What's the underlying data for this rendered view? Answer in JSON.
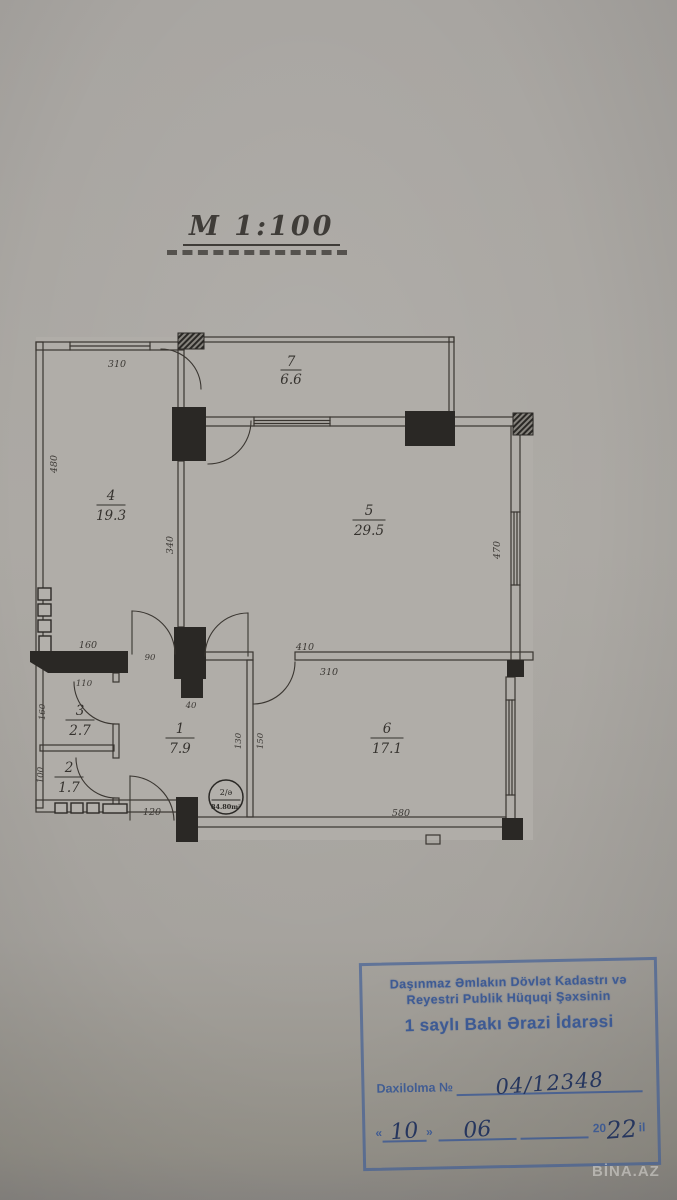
{
  "title": {
    "scale": "M 1:100"
  },
  "watermarks": {
    "center": "BİNA.AZ",
    "corner": "BİNA.AZ"
  },
  "plan": {
    "rooms": [
      {
        "number": "7",
        "area": "6.6"
      },
      {
        "number": "4",
        "area": "19.3"
      },
      {
        "number": "5",
        "area": "29.5"
      },
      {
        "number": "1",
        "area": "7.9"
      },
      {
        "number": "3",
        "area": "2.7"
      },
      {
        "number": "2",
        "area": "1.7"
      },
      {
        "number": "6",
        "area": "17.1"
      }
    ],
    "dims": {
      "room4_top": "310",
      "room4_left": "480",
      "divider_mid": "340",
      "room5_right": "470",
      "wall_thick": "160",
      "door_room4": "90",
      "corridor_right": "410",
      "room6_top": "310",
      "pillar": "40",
      "room3_top": "110",
      "room3_left": "160",
      "room2_left": "100",
      "hall_a": "130",
      "hall_b": "150",
      "entry_door": "120",
      "bottom": "580"
    },
    "unit_badge": {
      "top": "2/ə",
      "bottom": "84.80m²"
    }
  },
  "stamp": {
    "line1": "Daşınmaz Əmlakın Dövlət Kadastrı və",
    "line2": "Reyestri Publik Hüquqi Şəxsinin",
    "line3": "1 saylı Bakı Ərazi İdarəsi",
    "entry_label": "Daxilolma №",
    "entry_value": "04/12348",
    "quote_open": "«",
    "quote_close": "»",
    "day": "10",
    "month": "06",
    "century": "20",
    "year": "22",
    "suffix": "il"
  }
}
